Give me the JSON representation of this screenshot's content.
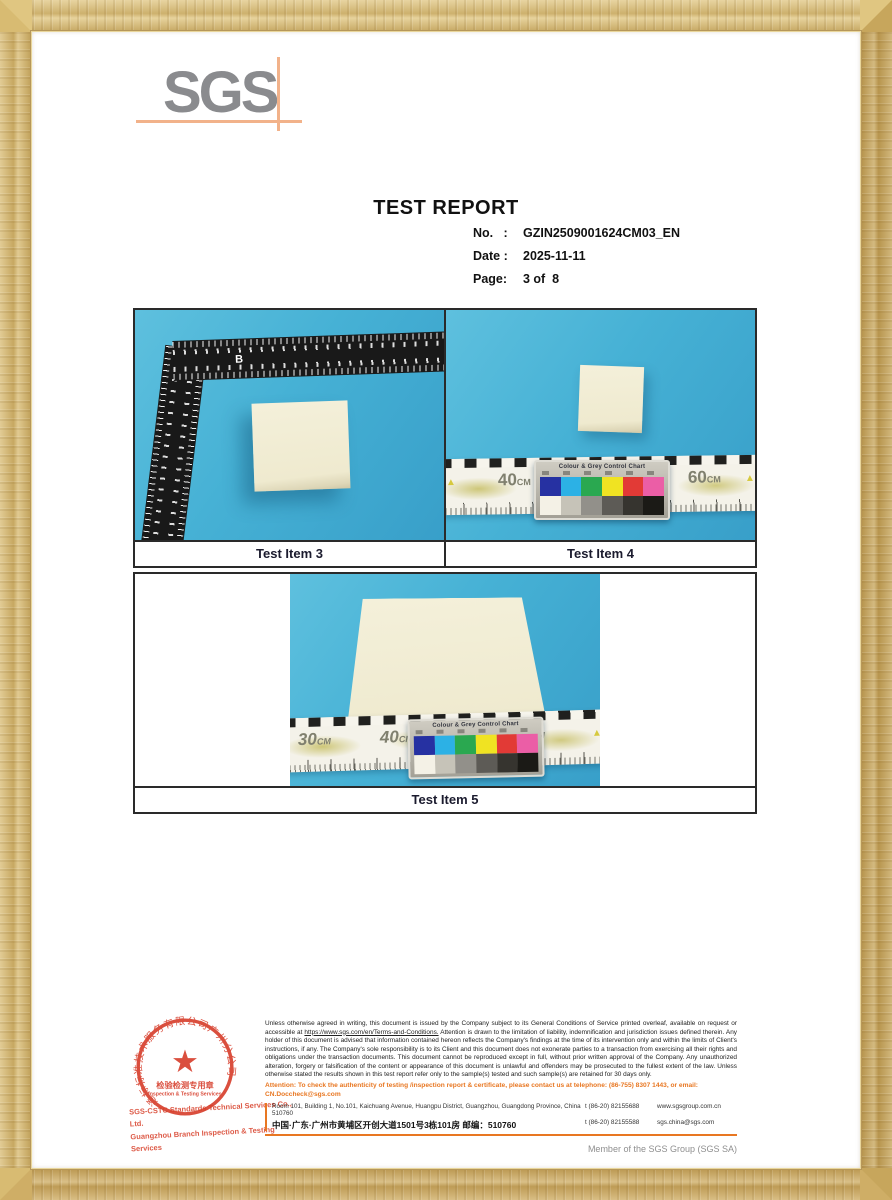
{
  "colors": {
    "accent_orange": "#e87722",
    "logo_gray": "#8a8b8e",
    "logo_crosshair_orange": "#f2b28a",
    "wood_frame": "#d3b169",
    "photo_background": "#46b1d5",
    "tile_cream": "#f2eed6",
    "stamp_red": "#d63c2a",
    "table_border": "#2a2a2a"
  },
  "logo": {
    "text": "SGS"
  },
  "header": {
    "title": "TEST REPORT",
    "meta": [
      {
        "label": "No.   :",
        "value": "GZIN2509001624CM03_EN"
      },
      {
        "label": "Date :",
        "value": "2025-11-11"
      },
      {
        "label": "Page:",
        "value": "3 of  8"
      }
    ]
  },
  "photos": {
    "item3": {
      "caption": "Test Item 3",
      "ruler_brand": "B"
    },
    "item4": {
      "caption": "Test Item 4",
      "labels": [
        {
          "num": "40",
          "unit": "CM"
        },
        {
          "num": "60",
          "unit": "CM"
        }
      ],
      "tri": "▲"
    },
    "item5": {
      "caption": "Test Item 5",
      "labels": [
        {
          "num": "30",
          "unit": "CM"
        },
        {
          "num": "40",
          "unit": "CM"
        },
        {
          "num": "60",
          "unit": "CM"
        }
      ],
      "tri": "▲"
    }
  },
  "color_chart": {
    "title": "Colour & Grey Control Chart",
    "top_colors": [
      "#2631a2",
      "#2cb1e5",
      "#2aa850",
      "#f0e322",
      "#e23a36",
      "#eb5ea6"
    ],
    "bottom_colors": [
      "#f4f1e6",
      "#c6c3b8",
      "#92908a",
      "#5d5b56",
      "#36342f",
      "#1b1a16"
    ]
  },
  "stamp": {
    "ring_text": "通标标准技术服务有限公司广州分公司",
    "star": "★",
    "center_line1": "检验检测专用章",
    "center_line2": "Inspection & Testing Services",
    "company_line1": "SGS-CSTC Standards Technical Services Co., Ltd.",
    "company_line2": "Guangzhou Branch  Inspection & Testing Services"
  },
  "footer": {
    "disclaimer_pre": "Unless otherwise agreed in writing, this document is issued by the Company subject to its General Conditions of Service printed overleaf, available on request or accessible at ",
    "disclaimer_link": "https://www.sgs.com/en/Terms-and-Conditions.",
    "disclaimer_post": " Attention is drawn to the limitation of liability, indemnification and jurisdiction issues defined therein. Any holder of this document is advised that information contained hereon reflects the Company's findings at the time of its intervention only and within the limits of Client's instructions, if any. The Company's sole responsibility is to its Client and this document does not exonerate parties to a transaction from exercising all their rights and obligations under the transaction documents. This document cannot be reproduced except in full, without prior written approval of the Company. Any unauthorized alteration, forgery or falsification of the content or appearance of this document is unlawful and offenders may be prosecuted to the fullest extent of the law. Unless otherwise stated the results shown in this test report refer only to the sample(s) tested and such sample(s) are retained for 30 days only.",
    "attention": "Attention: To check the authenticity of testing /inspection report & certificate, please contact us at telephone: (86-755) 8307 1443, or email: CN.Doccheck@sgs.com",
    "addresses": [
      {
        "text": "Room 101, Building 1, No.101, Kaichuang Avenue, Huangpu District, Guangzhou, Guangdong Province, China  510760",
        "phone": "t (86-20) 82155688",
        "site": "www.sgsgroup.com.cn"
      },
      {
        "text": "中国·广东·广州市黄埔区开创大道1501号3栋101房    邮编：510760",
        "phone": "t (86-20) 82155588",
        "site": "sgs.china@sgs.com"
      }
    ],
    "member": "Member of the SGS Group (SGS SA)"
  }
}
